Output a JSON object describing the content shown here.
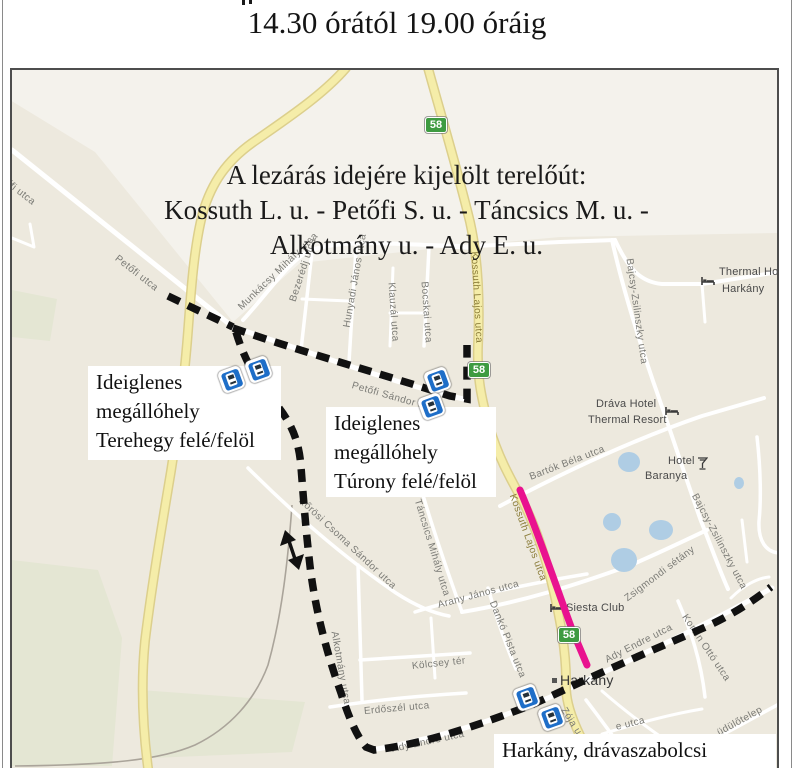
{
  "header": {
    "time_range": "14.30 órától 19.00 óráig"
  },
  "colors": {
    "map_bg": "#EDE9DE",
    "map_bg_light": "#F4F2EC",
    "green_area": "#E4E6D3",
    "water_blue": "#AFCDE4",
    "road_yellow": "#F5EDA9",
    "road_yellow_casing": "#DCCF8C",
    "route_black": "#111111",
    "closure_pink": "#E9128F",
    "badge_green": "#3E9B41",
    "bus_blue": "#1E6EC8"
  },
  "map": {
    "title_lines": [
      "A lezárás idejére kijelölt terelőút:",
      "Kossuth L. u. - Petőfi S. u. - Táncsics M. u. -",
      "Alkotmány u. - Ady E. u."
    ],
    "route_badges": [
      {
        "t": "58",
        "x": 425,
        "y": 117
      },
      {
        "t": "58",
        "x": 468,
        "y": 362
      },
      {
        "t": "58",
        "x": 558,
        "y": 627
      }
    ],
    "bus_stops": [
      {
        "x": 220,
        "y": 368
      },
      {
        "x": 247,
        "y": 358
      },
      {
        "x": 426,
        "y": 369
      },
      {
        "x": 420,
        "y": 395
      },
      {
        "x": 515,
        "y": 686
      },
      {
        "x": 540,
        "y": 706
      }
    ],
    "callouts": [
      {
        "lines": [
          "Ideiglenes",
          "megállóhely",
          "Terehegy felé/felöl"
        ],
        "x": 88,
        "y": 366,
        "w": 193,
        "h": 94
      },
      {
        "lines": [
          "Ideiglenes",
          "megállóhely",
          "Túrony felé/felöl"
        ],
        "x": 326,
        "y": 407,
        "w": 170,
        "h": 90
      },
      {
        "lines": [
          "Harkány, drávaszabolcsi"
        ],
        "x": 494,
        "y": 734,
        "w": 282,
        "h": 34
      }
    ],
    "street_labels": [
      {
        "t": "őfi utca",
        "x": 6,
        "y": 176,
        "r": 38
      },
      {
        "t": "Petőfi utca",
        "x": 116,
        "y": 252,
        "r": 38
      },
      {
        "t": "Munkácsy Mihály utca",
        "x": 240,
        "y": 303,
        "r": -44
      },
      {
        "t": "Bezerédj utca",
        "x": 293,
        "y": 296,
        "r": -72
      },
      {
        "t": "Hunyadi János utca",
        "x": 347,
        "y": 322,
        "r": -80
      },
      {
        "t": "Klauzál utca",
        "x": 391,
        "y": 277,
        "r": 86
      },
      {
        "t": "Bocskai utca",
        "x": 424,
        "y": 276,
        "r": 86
      },
      {
        "t": "Kossuth Lajos utca",
        "x": 474,
        "y": 246,
        "r": 87,
        "cls": "road"
      },
      {
        "t": "Kossuth Lajos utca",
        "x": 512,
        "y": 489,
        "r": 70,
        "cls": "road"
      },
      {
        "t": "Petőfi Sándor utca",
        "x": 352,
        "y": 380,
        "r": 16
      },
      {
        "t": "Bajcsy-Zsilinszky utca",
        "x": 629,
        "y": 253,
        "r": 82
      },
      {
        "t": "Bajcsy-Zsilinszky utca",
        "x": 694,
        "y": 489,
        "r": 62
      },
      {
        "t": "Bartók Béla utca",
        "x": 530,
        "y": 472,
        "r": -21
      },
      {
        "t": "Zsigmondi sétány",
        "x": 626,
        "y": 594,
        "r": -37
      },
      {
        "t": "Kőrösi Csoma Sándor utca",
        "x": 300,
        "y": 494,
        "r": 43
      },
      {
        "t": "Táncsics Mihály utca",
        "x": 417,
        "y": 494,
        "r": 73
      },
      {
        "t": "Alkotmány utca",
        "x": 334,
        "y": 626,
        "r": 80
      },
      {
        "t": "Arany János utca",
        "x": 438,
        "y": 600,
        "r": -15
      },
      {
        "t": "Dankó Pista utca",
        "x": 492,
        "y": 596,
        "r": 68
      },
      {
        "t": "Kölcsey tér",
        "x": 412,
        "y": 661,
        "r": -6
      },
      {
        "t": "Erdőszél utca",
        "x": 364,
        "y": 706,
        "r": -5
      },
      {
        "t": "Ady Endre utca",
        "x": 392,
        "y": 744,
        "r": -12
      },
      {
        "t": "Ady Endre utca",
        "x": 606,
        "y": 655,
        "r": -27
      },
      {
        "t": "Korvin Ottó utca",
        "x": 684,
        "y": 610,
        "r": 56
      },
      {
        "t": "üdülőtelep",
        "x": 718,
        "y": 728,
        "r": -29
      },
      {
        "t": "Zója u",
        "x": 563,
        "y": 703,
        "r": 58
      },
      {
        "t": "e utca",
        "x": 616,
        "y": 722,
        "r": -14
      }
    ],
    "poi_labels": [
      {
        "t": "Thermal Ho",
        "x": 719,
        "y": 266
      },
      {
        "t": "Harkány",
        "x": 722,
        "y": 283
      },
      {
        "t": "Dráva Hotel",
        "x": 596,
        "y": 398
      },
      {
        "t": "Thermal Resort",
        "x": 588,
        "y": 414
      },
      {
        "t": "Hotel",
        "x": 668,
        "y": 455
      },
      {
        "t": "Baranya",
        "x": 645,
        "y": 470
      },
      {
        "t": "Siesta Club",
        "x": 566,
        "y": 602
      },
      {
        "t": "Harkány",
        "x": 560,
        "y": 672,
        "cls": "town"
      }
    ],
    "poi_icons": [
      {
        "icon": "bed",
        "x": 701,
        "y": 276
      },
      {
        "icon": "bed",
        "x": 665,
        "y": 406
      },
      {
        "icon": "drink",
        "x": 697,
        "y": 457
      },
      {
        "icon": "bed",
        "x": 550,
        "y": 603
      },
      {
        "icon": "dot",
        "x": 552,
        "y": 678
      }
    ]
  }
}
